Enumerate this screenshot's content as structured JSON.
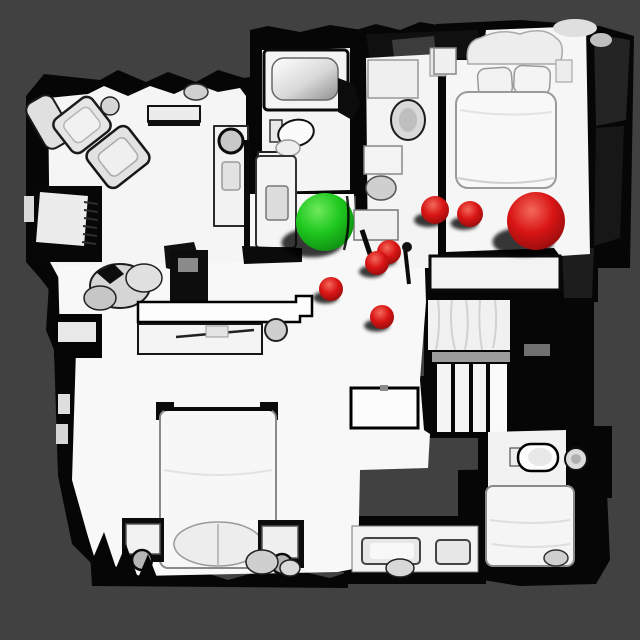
{
  "app": {
    "title": "Top-down 3D house scan render with waypoint spheres"
  },
  "scene": {
    "background_color": "#414141",
    "wall_color": "#060606",
    "floor_color": "#f6f6f6",
    "furniture_color": "#e9e9e9",
    "shadow_color": "rgba(8,8,8,0.78)",
    "view": "top-down orthographic mesh render"
  },
  "markers": {
    "large_green_sphere": {
      "cx": 325,
      "cy": 222,
      "r": 29,
      "color_name": "green"
    },
    "large_red_sphere": {
      "cx": 536,
      "cy": 221,
      "r": 29,
      "color_name": "red"
    },
    "small_red_spheres": [
      {
        "cx": 435,
        "cy": 210,
        "r": 14
      },
      {
        "cx": 470,
        "cy": 214,
        "r": 13
      },
      {
        "cx": 389,
        "cy": 252,
        "r": 12
      },
      {
        "cx": 377,
        "cy": 263,
        "r": 12
      },
      {
        "cx": 331,
        "cy": 289,
        "r": 12
      },
      {
        "cx": 382,
        "cy": 317,
        "r": 12
      }
    ],
    "green_gradient": {
      "highlight": "#6fe95c",
      "mid": "#1fc91f",
      "edge": "#0b7d0e"
    },
    "red_gradient": {
      "highlight": "#f4695a",
      "mid": "#d81414",
      "edge": "#7d0b0b"
    }
  },
  "rooms": [
    {
      "name": "living-room",
      "area": "top-left"
    },
    {
      "name": "kitchen-dining",
      "area": "mid-left"
    },
    {
      "name": "bathroom-main",
      "area": "top-middle"
    },
    {
      "name": "ensuite-bathroom",
      "area": "top-middle-right"
    },
    {
      "name": "bedroom-master",
      "area": "top-right"
    },
    {
      "name": "hallway",
      "area": "center"
    },
    {
      "name": "staircase",
      "area": "mid-right"
    },
    {
      "name": "bathroom-lower",
      "area": "bottom-right-middle"
    },
    {
      "name": "bedroom-lower-left",
      "area": "bottom-left"
    },
    {
      "name": "bedroom-lower-right",
      "area": "bottom-right"
    }
  ],
  "furniture": [
    "sofa-group",
    "cabinet",
    "console",
    "vanity-desk",
    "bathtub",
    "toilet",
    "bed",
    "pillows",
    "nightstand",
    "counter",
    "stairs",
    "banister",
    "dresser",
    "sink",
    "curtain"
  ]
}
